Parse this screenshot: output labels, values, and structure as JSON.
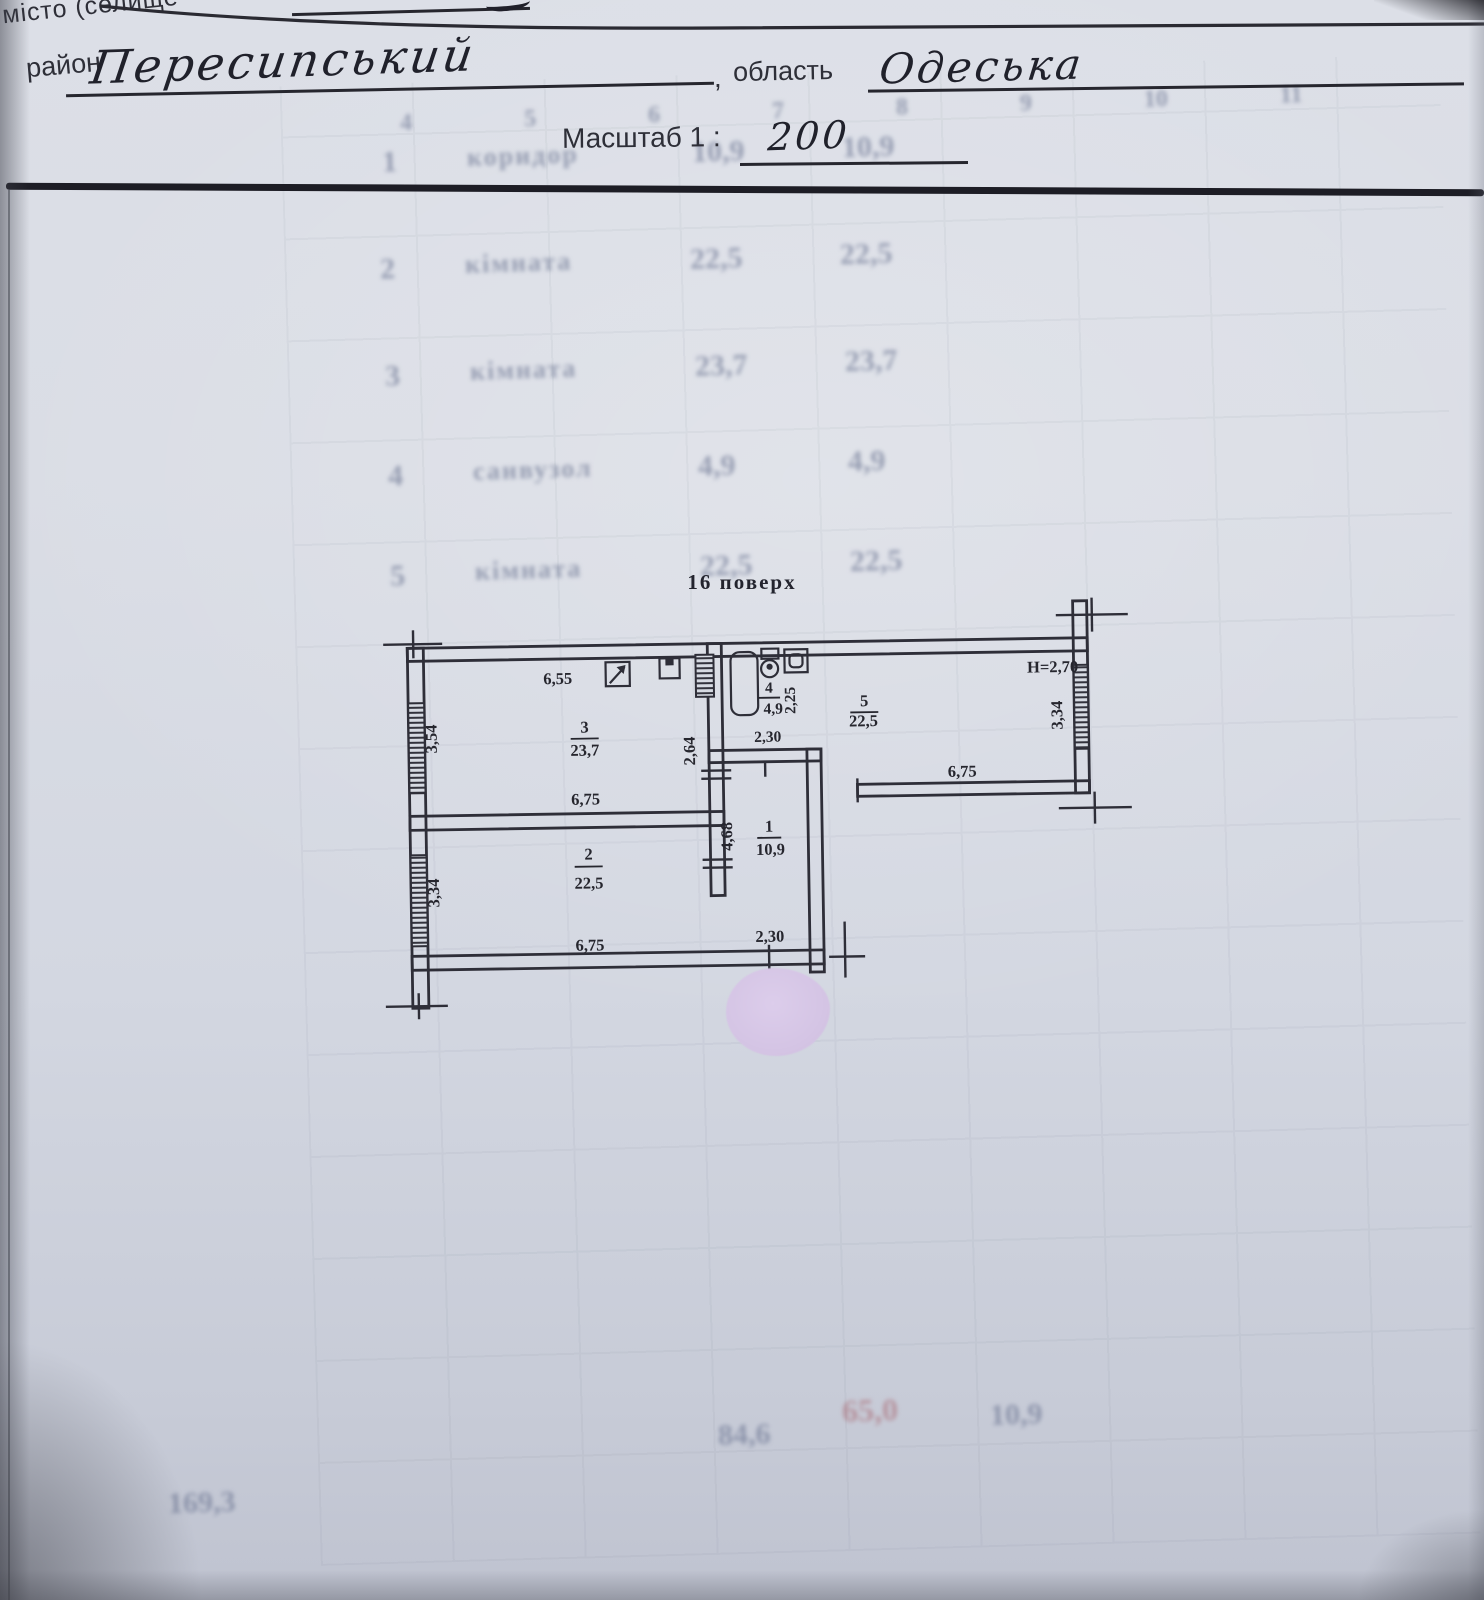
{
  "header": {
    "top_left_partial": "місто (селище",
    "district_label": "район",
    "district_value": "Пересипський",
    "comma": ",",
    "region_label": "область",
    "region_value": "Одеська",
    "scale_label": "Масштаб 1 :",
    "scale_value": "200"
  },
  "plan": {
    "title": "16 поверх",
    "height_note": "H=2,70",
    "rooms": {
      "r1": {
        "num": "1",
        "area": "10,9",
        "dim_left": "4,68",
        "dim_bottom": "2,30"
      },
      "r2": {
        "num": "2",
        "area": "22,5",
        "dim_left": "3,34",
        "dim_bottom": "6,75"
      },
      "r3": {
        "num": "3",
        "area": "23,7",
        "dim_top": "6,55",
        "dim_bottom": "6,75",
        "dim_left": "3,54",
        "dim_right": "2,64"
      },
      "r4": {
        "num": "4",
        "area": "4,9",
        "dim_right": "2,25",
        "dim_bottom": "2,30"
      },
      "r5": {
        "num": "5",
        "area": "22,5",
        "dim_bottom": "6,75",
        "dim_right": "3,34"
      }
    },
    "icons": [
      "electric-panel-icon",
      "doorbell-box-icon",
      "vent-shaft-icon",
      "bathtub-icon",
      "toilet-icon",
      "sink-icon"
    ],
    "ink_color": "#2e2e38",
    "paper_color": "#d6dae2",
    "redaction_color": "#d5c5e5"
  },
  "ghost": {
    "column_numbers": [
      "4",
      "5",
      "6",
      "7",
      "8",
      "9",
      "10",
      "11"
    ],
    "rows": [
      {
        "n": "1",
        "name": "коридор",
        "a": "10,9",
        "b": "10,9"
      },
      {
        "n": "2",
        "name": "кімната",
        "a": "22,5",
        "b": "22,5"
      },
      {
        "n": "3",
        "name": "кімната",
        "a": "23,7",
        "b": "23,7"
      },
      {
        "n": "4",
        "name": "санвузол",
        "a": "4,9",
        "b": "4,9"
      },
      {
        "n": "5",
        "name": "кімната",
        "a": "22,5",
        "b": "22,5"
      }
    ],
    "totals": {
      "a": "84,6",
      "b": "65,0",
      "c": "10,9"
    },
    "footer": "169,3"
  }
}
